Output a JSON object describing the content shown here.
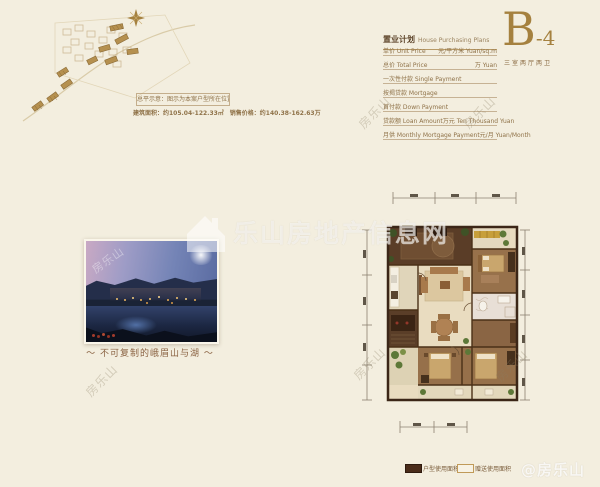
{
  "site_plan": {
    "note_box": "总平示意：图示为本案户型所在位置",
    "area_price": "建筑面积：约105.04-122.33㎡　销售价格：约140.38-162.63万"
  },
  "photo": {
    "caption": "～ 不可复制的峨眉山与湖 ～"
  },
  "purchase_plan": {
    "title_cn": "置业计划",
    "title_en": "House Purchasing Plans",
    "rows": [
      {
        "label": "单价 Unit Price",
        "unit": "元/平方米 Yuan/sq.m"
      },
      {
        "label": "总价 Total Price",
        "unit": "万 Yuan"
      },
      {
        "label": "一次性付款 Single Payment",
        "unit": ""
      },
      {
        "label": "按揭贷款 Mortgage",
        "unit": ""
      },
      {
        "label": "首付款 Down Payment",
        "unit": ""
      },
      {
        "label": "贷款额 Loan Amount",
        "unit": "万元 Ten Thousand Yuan"
      },
      {
        "label": "月供 Monthly Mortgage Payment",
        "unit": "元/月 Yuan/Month"
      }
    ]
  },
  "unit_badge": {
    "letter": "B",
    "dash": "-",
    "number": "4",
    "layout_type": "三室两厅两卫"
  },
  "floor_plan_legend": [
    {
      "label": "户型使用面积",
      "style": "filled"
    },
    {
      "label": "赠送使用面积",
      "style": "outline"
    }
  ],
  "watermarks": {
    "center_logo": "乐山房地产信息网",
    "diagonal": "房乐山",
    "corner": "@房乐山"
  },
  "colors": {
    "background": "#f3eedf",
    "accent_gold": "#a5813f",
    "text_brown": "#8f7248",
    "wall_dark": "#3b2617",
    "legend_fill": "#4a2c1a"
  }
}
